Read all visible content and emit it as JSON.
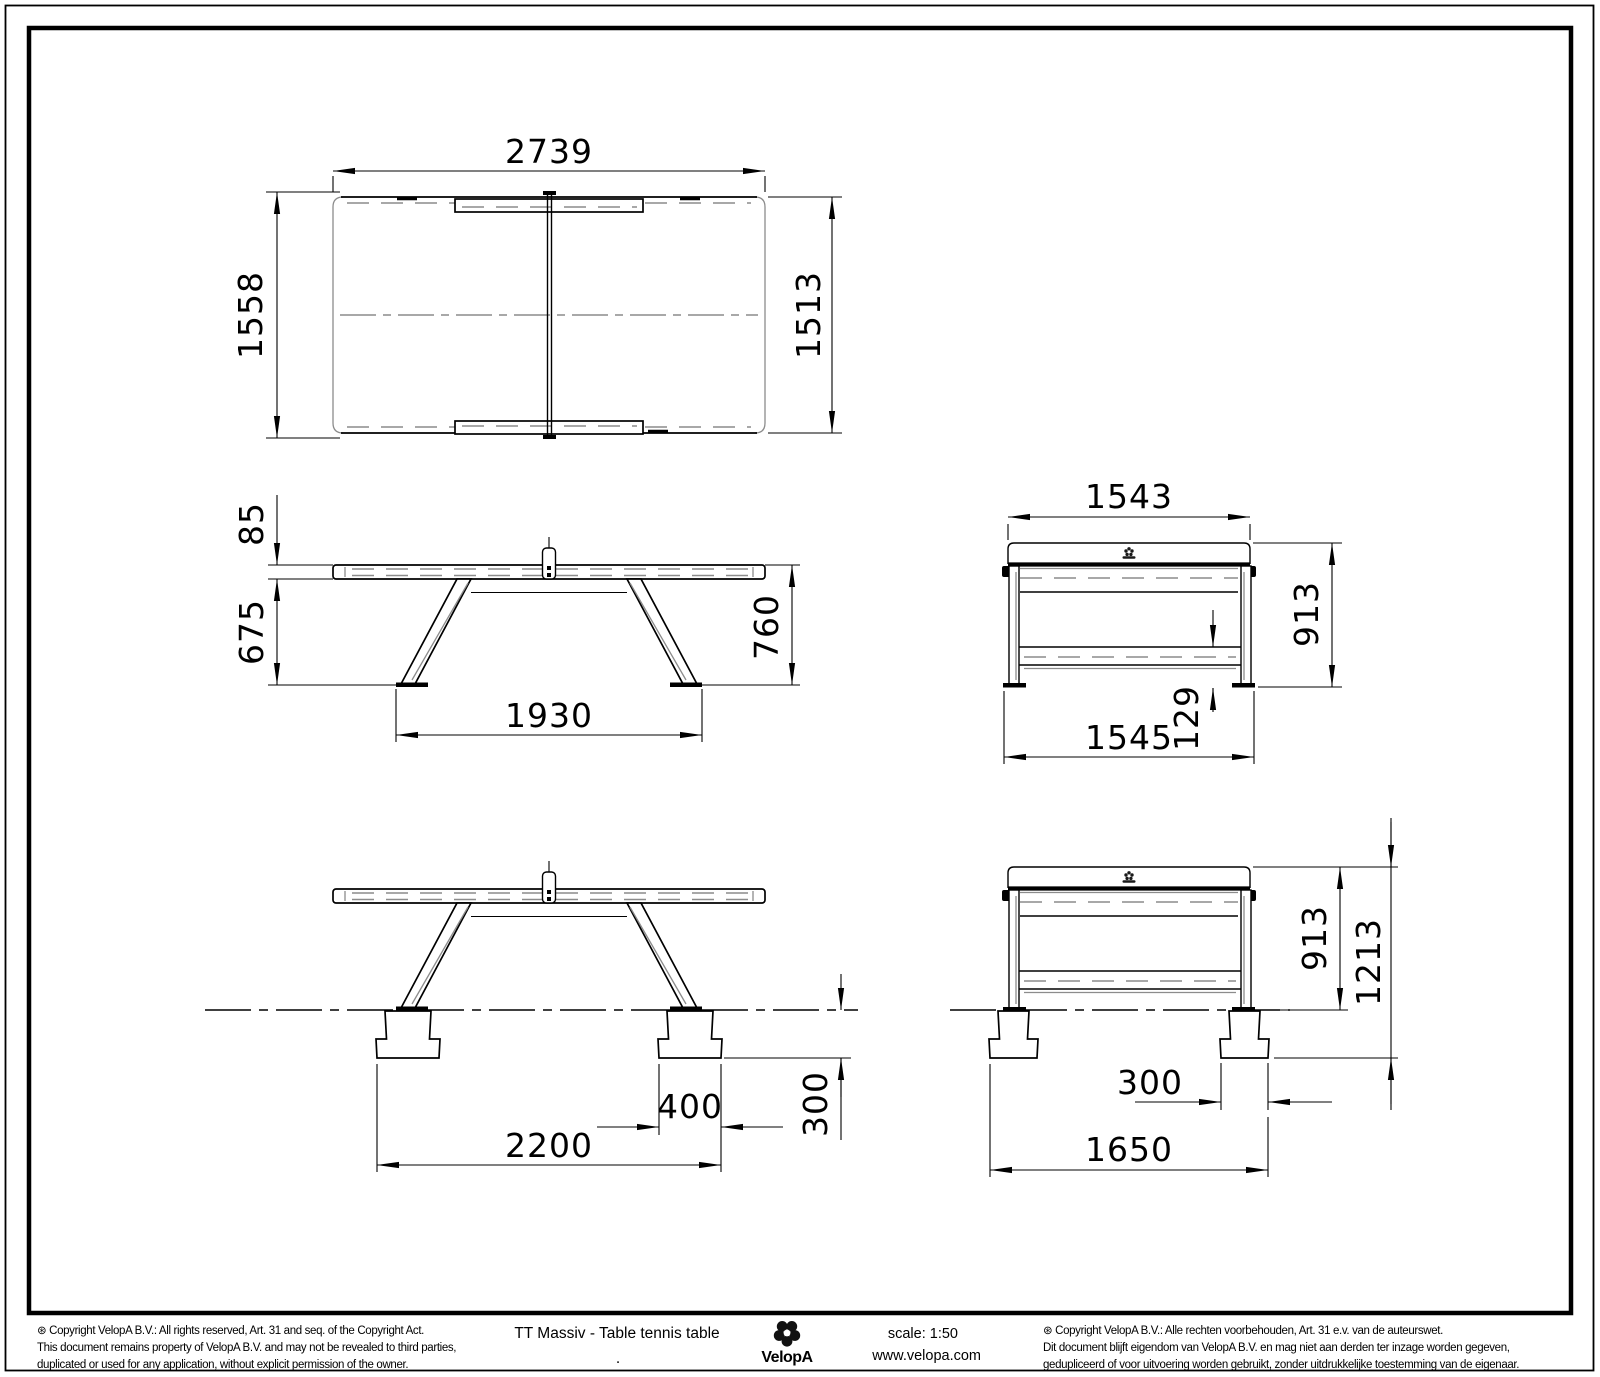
{
  "colors": {
    "line": "#000000",
    "hidden_line": "#8c8c8c",
    "background": "#ffffff"
  },
  "dims": {
    "top_length": "2739",
    "top_width_overall": "1558",
    "top_width_surface": "1513",
    "side_top_thickness": "85",
    "side_underside_height": "675",
    "side_surface_height": "760",
    "side_leg_spread": "1930",
    "end_top_width": "1543",
    "end_height": "913",
    "end_leg_spread": "1545",
    "end_rail_clearance": "129",
    "inst_side_footing_length": "400",
    "inst_side_footing_spread": "2200",
    "inst_footing_depth": "300",
    "inst_end_footing_width": "300",
    "inst_end_height": "913",
    "inst_end_total_height": "1213",
    "inst_end_footing_spread": "1650"
  },
  "footer": {
    "copyright_en": [
      "⊛  Copyright VelopA B.V.: All rights reserved, Art. 31 and seq. of the Copyright Act.",
      "This document remains property of VelopA B.V. and may not be revealed to third parties,",
      "duplicated or used for any application, without explicit permission of the owner."
    ],
    "title": "TT Massiv - Table tennis table",
    "title_dot": ".",
    "brand": "VelopA",
    "scale_label": "scale: 1:50",
    "website": "www.velopa.com",
    "copyright_nl": [
      "⊛  Copyright VelopA B.V.: Alle rechten voorbehouden, Art. 31 e.v. van de auteurswet.",
      "Dit document blijft eigendom van VelopA B.V. en mag niet aan derden ter inzage worden gegeven,",
      "gedupliceerd of voor uitvoering worden gebruikt, zonder uitdrukkelijke toestemming van de eigenaar."
    ]
  }
}
